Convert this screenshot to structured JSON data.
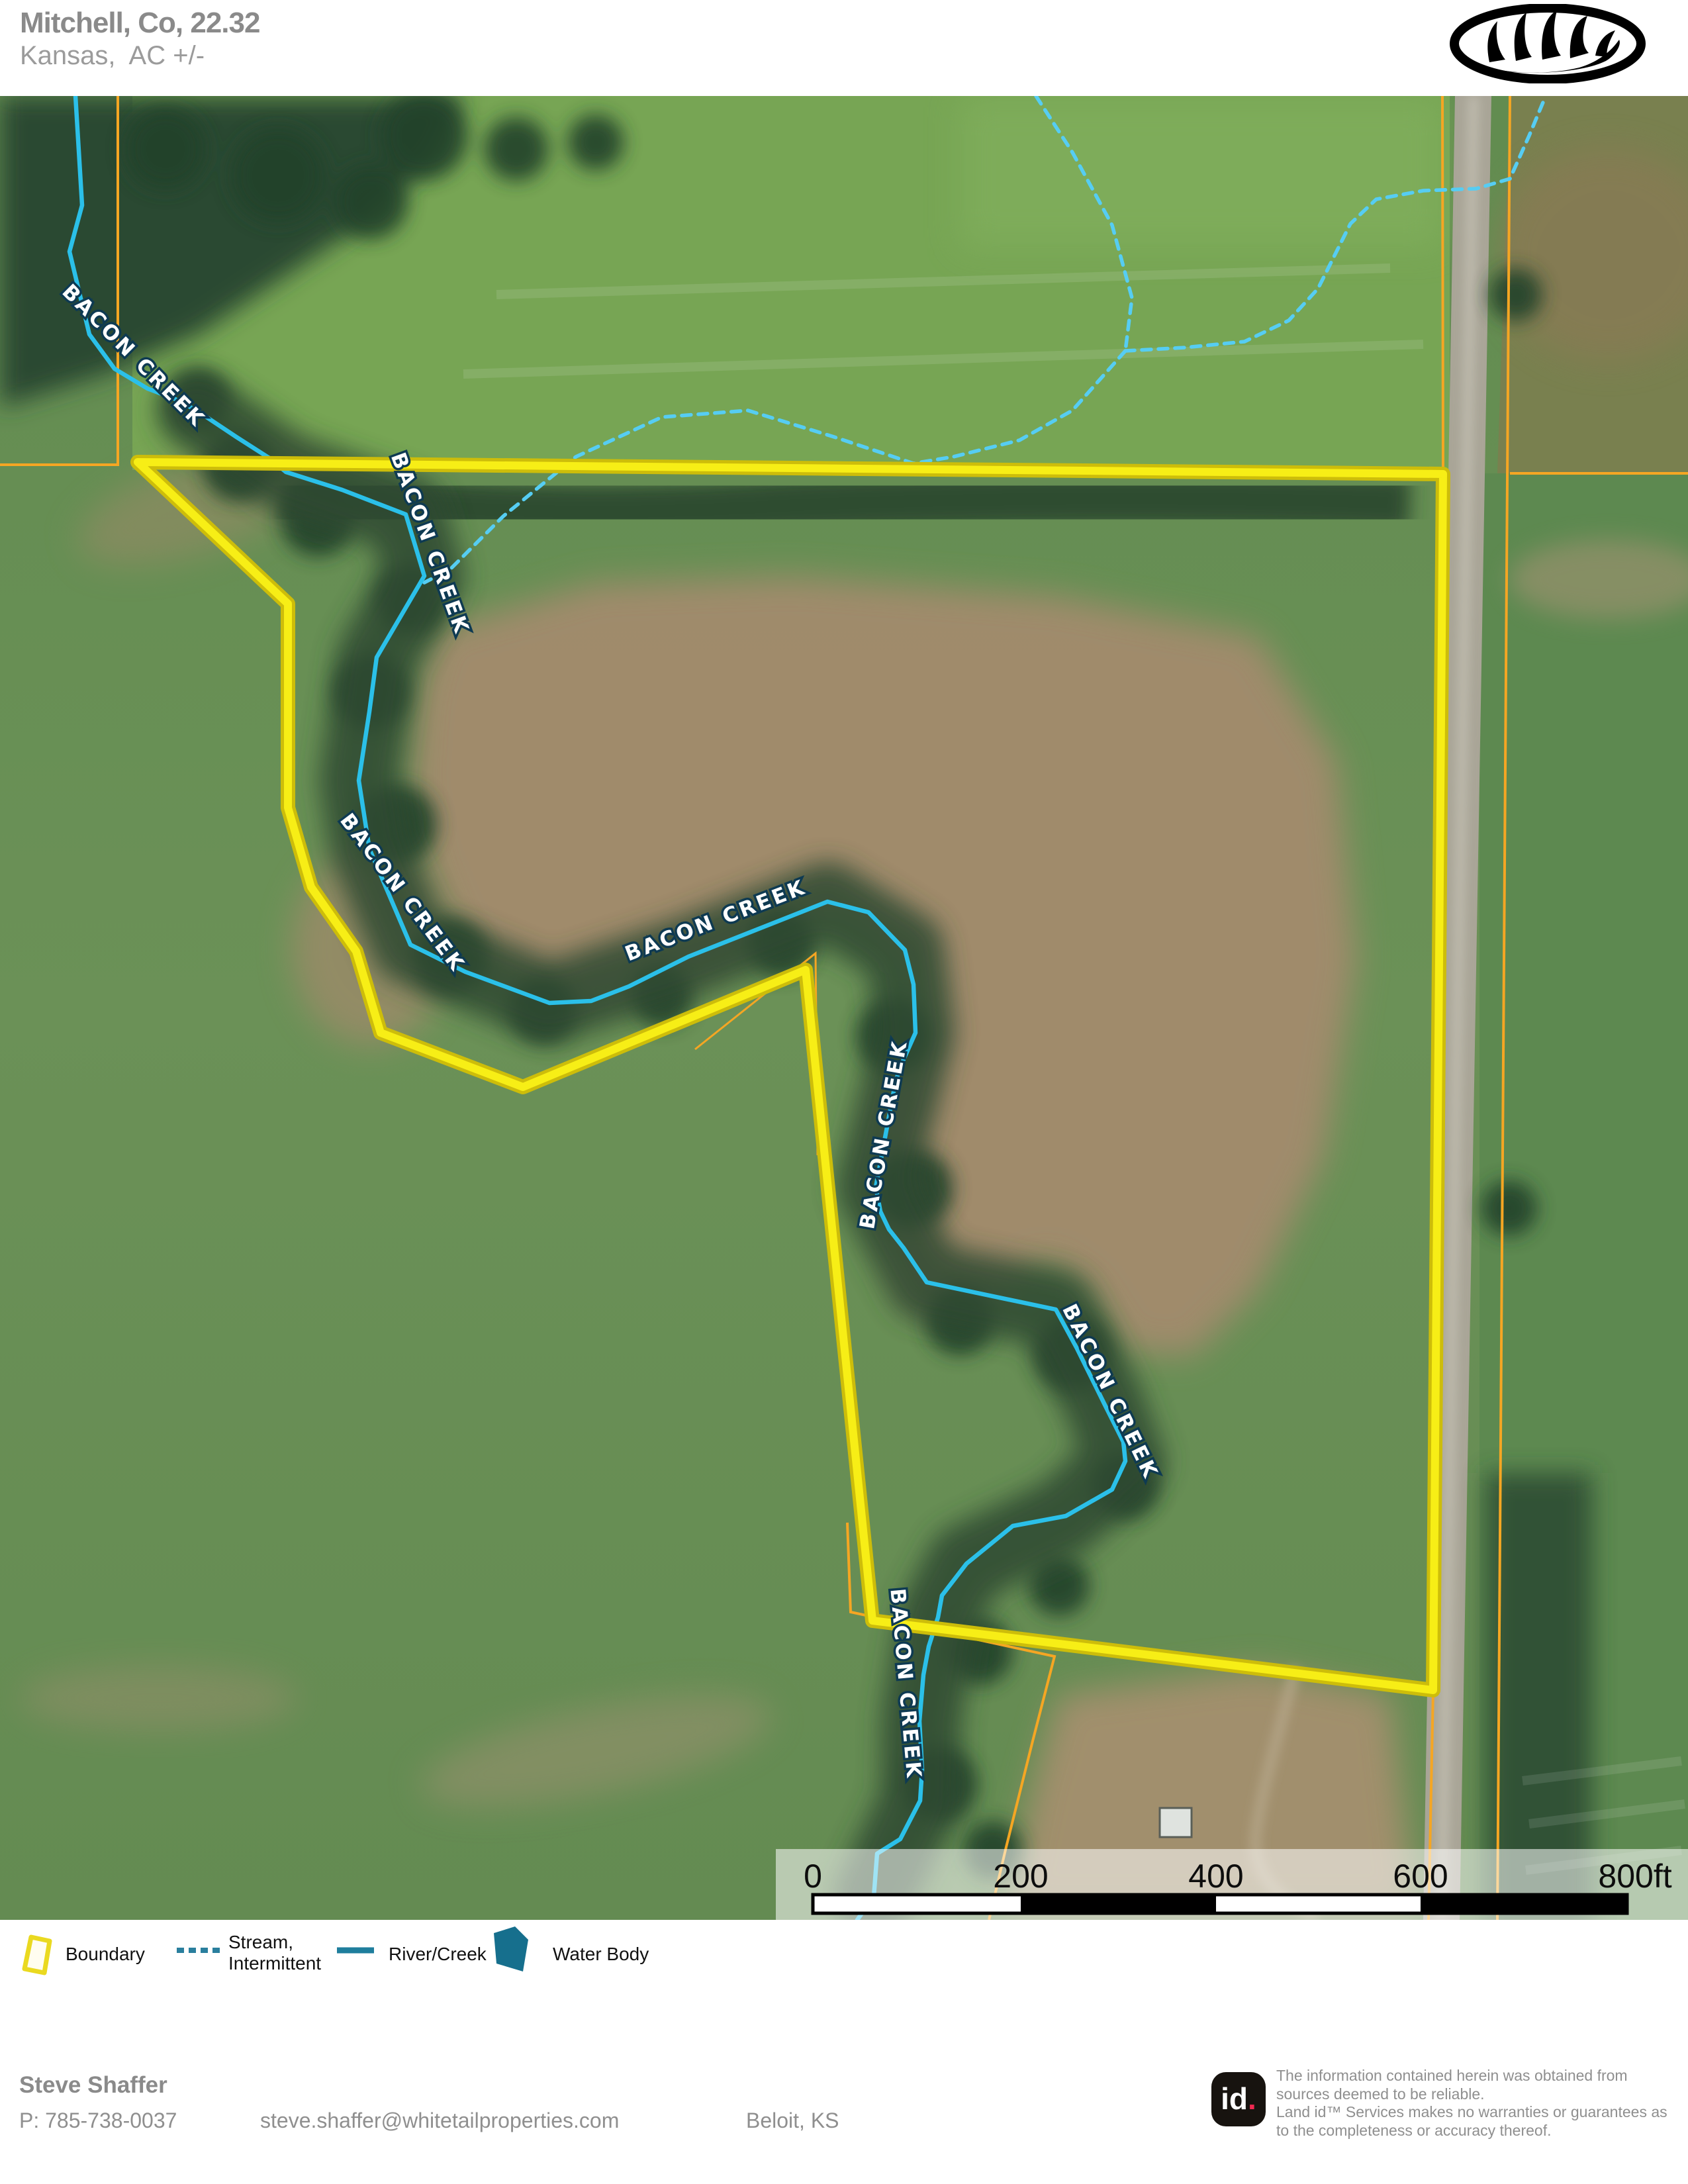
{
  "header": {
    "title": "Mitchell, Co, 22.32",
    "subtitle": "Kansas,  AC +/-",
    "logo": "whitetail-properties-antler-logo"
  },
  "map": {
    "creek_labels": [
      {
        "text": "BACON CREEK"
      },
      {
        "text": "BACON CREEK"
      },
      {
        "text": "BACON CREEK"
      },
      {
        "text": "BACON CREEK"
      },
      {
        "text": "BACON CREEK"
      },
      {
        "text": "BACON CREEK"
      },
      {
        "text": "BACON CREEK"
      }
    ],
    "colors": {
      "boundary": "#f4e90e",
      "parcel_line": "#f5a623",
      "river_creek": "#2bc0e9",
      "intermittent_stream": "#56cdf3"
    }
  },
  "scalebar": {
    "ticks": [
      "0",
      "200",
      "400",
      "600",
      "800ft"
    ]
  },
  "legend": {
    "items": [
      {
        "label": "Boundary"
      },
      {
        "label": "Stream,\nIntermittent"
      },
      {
        "label": "River/Creek"
      },
      {
        "label": "Water Body"
      }
    ]
  },
  "footer": {
    "agent_name": "Steve Shaffer",
    "phone": "P: 785-738-0037",
    "email": "steve.shaffer@whitetailproperties.com",
    "city": "Beloit, KS",
    "brand_id": "id",
    "brand_dot": ".",
    "disclaimer": "The information contained herein was obtained from sources deemed to be reliable.\n Land id™ Services makes no warranties or guarantees as to the completeness or accuracy thereof."
  }
}
